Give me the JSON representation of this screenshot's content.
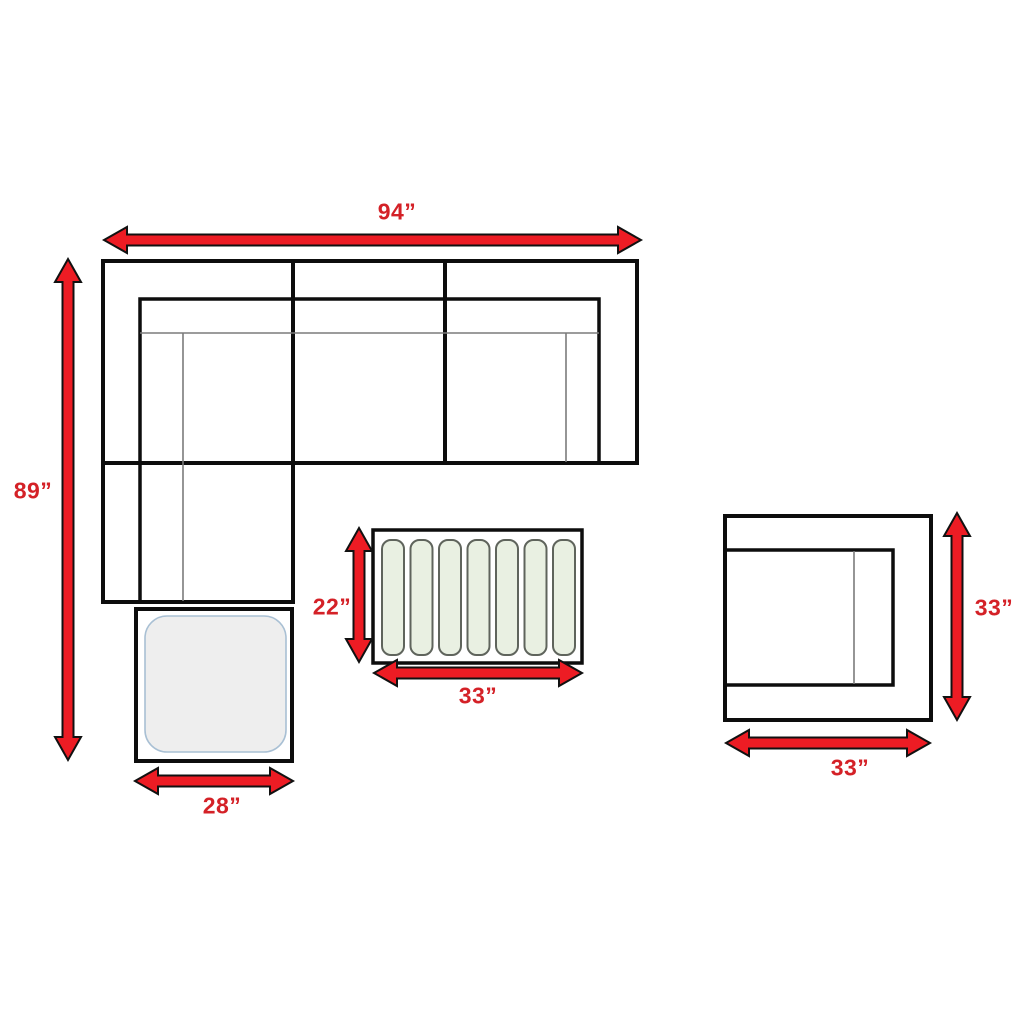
{
  "diagram": {
    "type": "furniture-dimension-diagram",
    "colors": {
      "arrow": "#ed1c24",
      "label_text": "#d42127",
      "outline": "#0d0d0d",
      "thin_line": "#7b7b7b",
      "slat_fill": "#e9f0e2",
      "slat_border": "#5f645c",
      "ottoman_cushion_fill": "#eeeeee",
      "ottoman_cushion_border": "#a9c0d4"
    },
    "sectional_sofa": {
      "width_label": "94”",
      "height_label": "89”"
    },
    "ottoman": {
      "width_label": "28”"
    },
    "coffee_table": {
      "slat_count": 7,
      "height_label": "22”",
      "width_label": "33”"
    },
    "side_chair": {
      "height_label": "33”",
      "width_label": "33”"
    }
  }
}
